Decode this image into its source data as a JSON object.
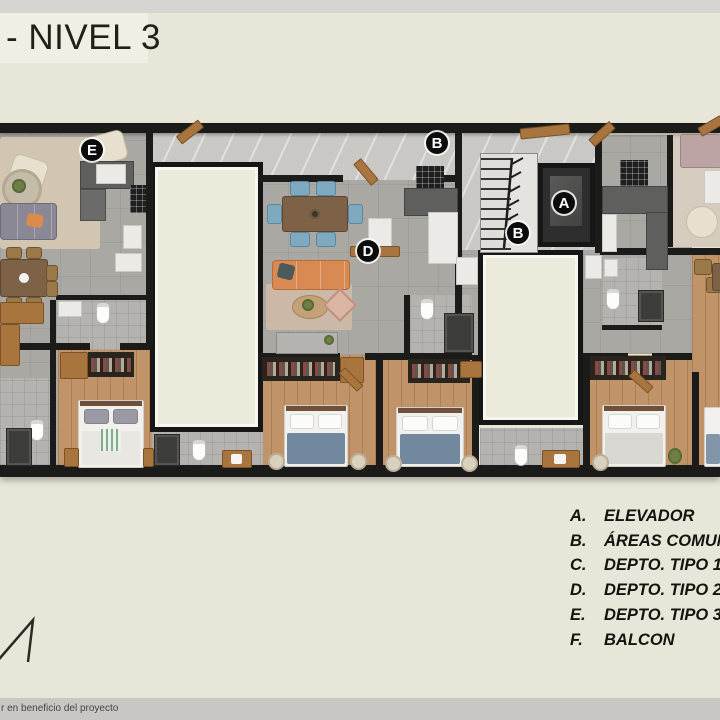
{
  "slide": {
    "title": "- NIVEL 3",
    "footer": "r en beneficio del proyecto"
  },
  "legend": {
    "items": [
      {
        "key": "A.",
        "label": "ELEVADOR"
      },
      {
        "key": "B.",
        "label": "ÁREAS COMUNES"
      },
      {
        "key": "C.",
        "label": "DEPTO. TIPO 1"
      },
      {
        "key": "D.",
        "label": "DEPTO. TIPO 2"
      },
      {
        "key": "E.",
        "label": "DEPTO. TIPO 3"
      },
      {
        "key": "F.",
        "label": "BALCON"
      }
    ]
  },
  "plan": {
    "labels": [
      {
        "letter": "E"
      },
      {
        "letter": "B"
      },
      {
        "letter": "A"
      },
      {
        "letter": "B"
      },
      {
        "letter": "D"
      }
    ]
  },
  "colors": {
    "background": "#e8e6d9",
    "wall": "#1b1b19",
    "void_fill": "#eceadb",
    "wood_floor": "#c09468",
    "orange_sofa": "#d98a52",
    "blue_bed": "#72889f"
  }
}
